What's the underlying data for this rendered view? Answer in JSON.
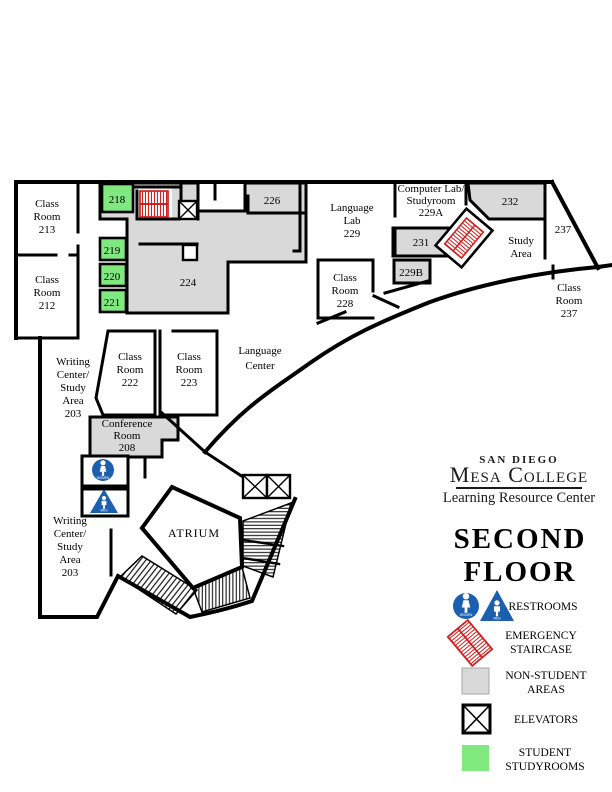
{
  "map": {
    "labels": {
      "room213": [
        "Class",
        "Room",
        "213"
      ],
      "room212": [
        "Class",
        "Room",
        "212"
      ],
      "room218": "218",
      "room219": "219",
      "room220": "220",
      "room221": "221",
      "room224": "224",
      "room226": "226",
      "language_lab": [
        "Language",
        "Lab",
        "229"
      ],
      "computer_lab": [
        "Computer Lab/",
        "Studyroom",
        "229A"
      ],
      "room232": "232",
      "corridor237": "237",
      "study_area": [
        "Study",
        "Area"
      ],
      "room231": "231",
      "room229b": "229B",
      "room228": [
        "Class",
        "Room",
        "228"
      ],
      "room237": [
        "Class",
        "Room",
        "237"
      ],
      "language_center": [
        "Language",
        "Center"
      ],
      "writing_center_north": [
        "Writing",
        "Center/",
        "Study",
        "Area",
        "203"
      ],
      "writing_center_south": [
        "Writing",
        "Center/",
        "Study",
        "Area",
        "203"
      ],
      "conference": [
        "Conference",
        "Room",
        "208"
      ],
      "atrium": "ATRIUM",
      "women": "WOMEN",
      "men": "MEN"
    },
    "colors": {
      "non_student_gray": "#d9d9d9",
      "student_studyroom_green": "#7fe87f",
      "emergency_red": "#ce2020",
      "restroom_blue": "#1b5fae",
      "wall_black": "#000000"
    }
  },
  "branding": {
    "school_line1": "SAN DIEGO",
    "school_line2": "Mesa College",
    "division": "Learning Resource Center"
  },
  "floor_title": {
    "line1": "SECOND",
    "line2": "FLOOR"
  },
  "legend": {
    "items": [
      {
        "icon": "restrooms",
        "label_lines": [
          "RESTROOMS"
        ]
      },
      {
        "icon": "emergency-staircase",
        "label_lines": [
          "EMERGENCY",
          "STAIRCASE"
        ]
      },
      {
        "icon": "non-student-areas",
        "label_lines": [
          "NON-STUDENT",
          "AREAS"
        ]
      },
      {
        "icon": "elevators",
        "label_lines": [
          "ELEVATORS"
        ]
      },
      {
        "icon": "student-studyrooms",
        "label_lines": [
          "STUDENT",
          "STUDYROOMS"
        ]
      }
    ]
  }
}
